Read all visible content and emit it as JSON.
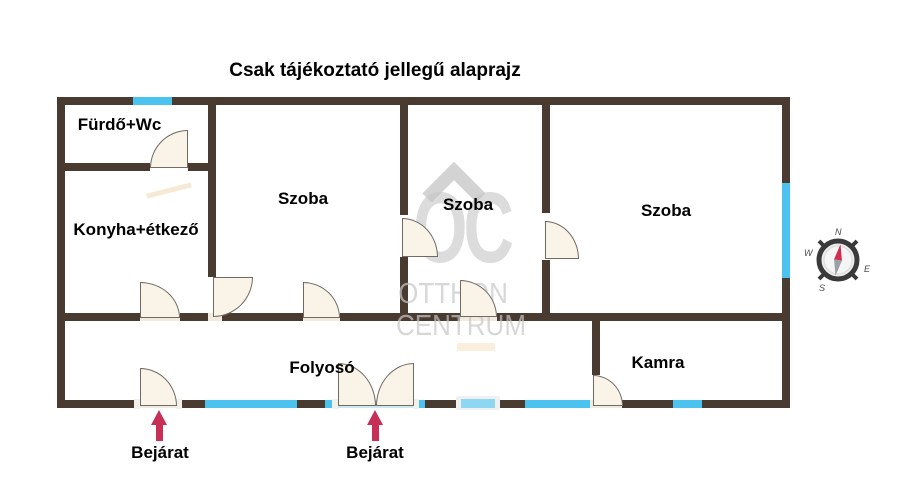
{
  "title": "Csak tájékoztató jellegű alaprajz",
  "rooms": [
    {
      "label": "Fürdő+Wc"
    },
    {
      "label": "Konyha+étkező"
    },
    {
      "label": "Szoba"
    },
    {
      "label": "Szoba"
    },
    {
      "label": "Szoba"
    },
    {
      "label": "Folyosó"
    },
    {
      "label": "Kamra"
    }
  ],
  "entrances": [
    {
      "label": "Bejárat"
    },
    {
      "label": "Bejárat"
    }
  ],
  "compass": {
    "n": "N",
    "e": "E",
    "s": "S",
    "w": "W"
  },
  "watermark": {
    "monogram": "OC",
    "line1": "OTTHON",
    "line2": "CENTRUM"
  },
  "colors": {
    "wall": "#4a3b31",
    "window": "#4cc3ee",
    "window-light": "#8ed7f2",
    "threshold": "#cde8f1",
    "door-fill": "#faf3e7",
    "door-stroke": "#6f6a62",
    "sill": "#f1ebdf",
    "arrow": "#c72f56",
    "watermark": "#c7c7c7",
    "text": "#000000",
    "compass-needle": "#d22c4e",
    "compass-ring": "#3a3a3a"
  }
}
